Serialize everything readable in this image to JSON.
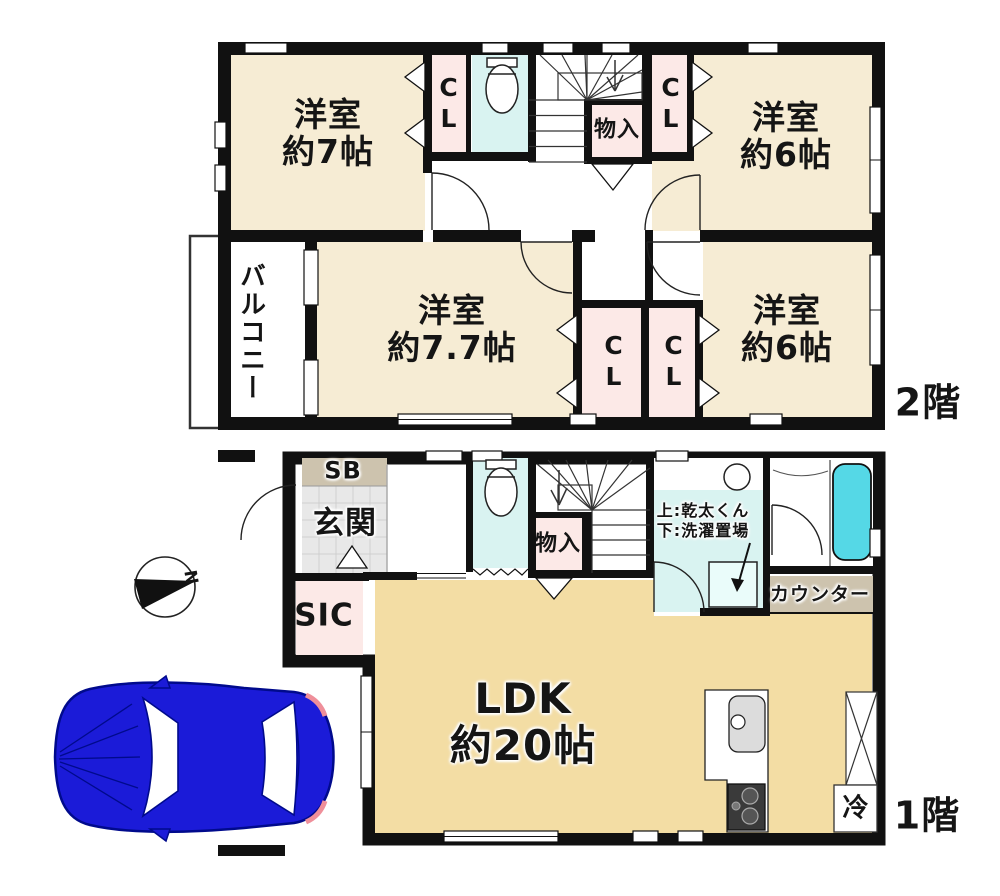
{
  "colors": {
    "wall": "#111111",
    "room_cream": "#f6ecd4",
    "closet_pink": "#fce9e7",
    "wet_cyan": "#d9f3f1",
    "bathtub_cyan": "#55d8e6",
    "ldk_tan": "#f3dda4",
    "entrance_gray": "#e8e8e8",
    "counter_tan": "#cdc3ae",
    "car_blue": "#1b1bd8"
  },
  "floor2": {
    "floor_label": "2階",
    "room_nw": "洋室\n約7帖",
    "closet_nw": "CL",
    "storage": "物入",
    "closet_ne": "CL",
    "room_ne": "洋室\n約6帖",
    "balcony": "バルコニー",
    "room_sw": "洋室\n約7.7帖",
    "closet_sw": "CL",
    "closet_se": "CL",
    "room_se": "洋室\n約6帖"
  },
  "floor1": {
    "floor_label": "1階",
    "shoe_box": "SB",
    "entrance": "玄関",
    "shoe_closet": "SIC",
    "storage": "物入",
    "laundry_note": "上:乾太くん\n下:洗濯置場",
    "counter": "カウンター",
    "ldk": "LDK\n約20帖",
    "fridge": "冷"
  },
  "compass": {
    "north": "N"
  }
}
